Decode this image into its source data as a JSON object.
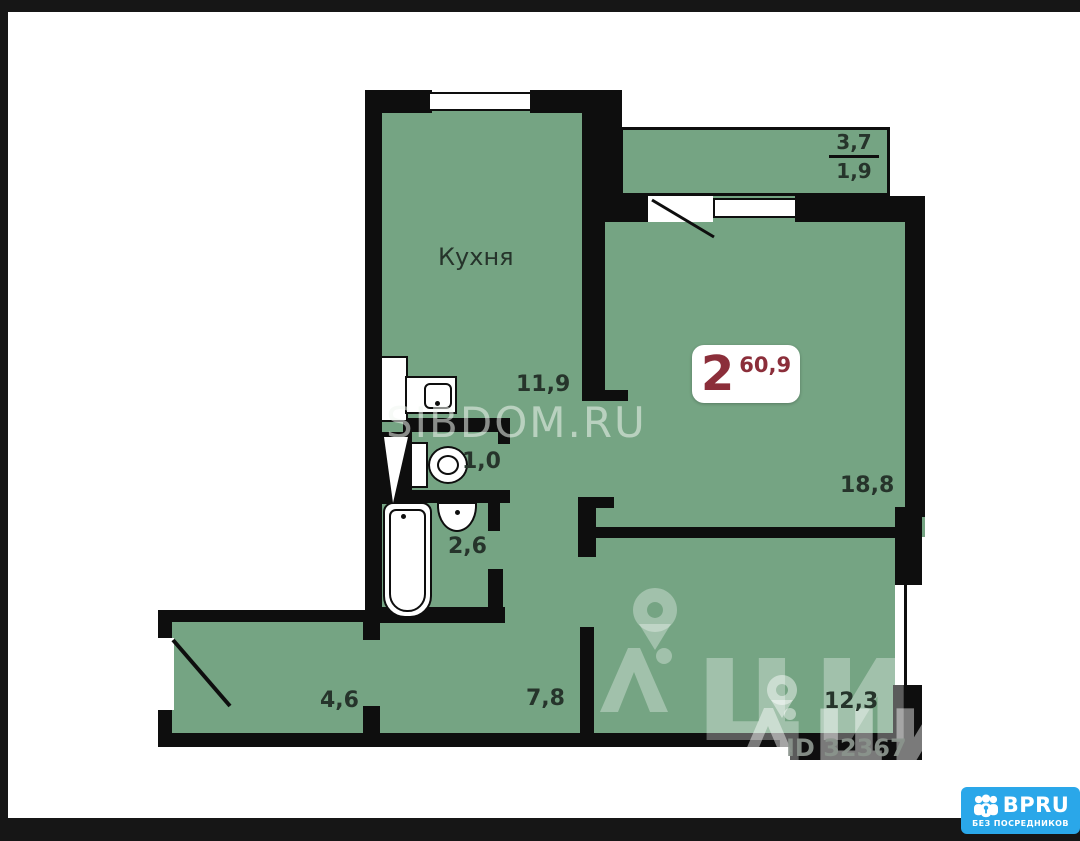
{
  "page": {
    "background_color": "#161616",
    "paper_color": "#ffffff"
  },
  "plan": {
    "floor_color": "#75a483",
    "wall_color": "#0e0e0e",
    "label_color": "#26342b",
    "rooms": {
      "kitchen": {
        "label": "Кухня",
        "area": "11,9"
      },
      "living": {
        "area": "18,8"
      },
      "bedroom": {
        "area": "12,3"
      },
      "wc": {
        "area": "1,0"
      },
      "bath": {
        "area": "2,6"
      },
      "hall": {
        "area": "4,6"
      },
      "corridor": {
        "area": "7,8"
      },
      "balcony": {
        "area_total": "3,7",
        "area_reduced": "1,9"
      }
    },
    "badge": {
      "rooms": "2",
      "area": "60,9",
      "accent_color": "#8b2e3a"
    }
  },
  "watermarks": {
    "sibdom": "SIBDOM.RU",
    "cian_large": "циан",
    "cian_small": "циан",
    "listing_id": "ID 32367"
  },
  "branding": {
    "name": "BPRU",
    "tagline": "БЕЗ ПОСРЕДНИКОВ",
    "color": "#2aa7e9"
  }
}
